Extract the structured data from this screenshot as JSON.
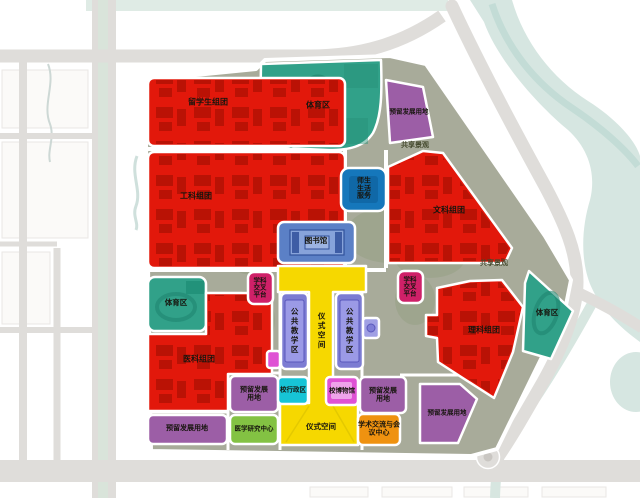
{
  "map": {
    "labels": {
      "intl_students": "留学生组团",
      "engineering": "工科组团",
      "liberal_arts": "文科组团",
      "science": "理科组团",
      "medical": "医科组团",
      "sports": "体育区",
      "library": "图书馆",
      "public_teaching": "公共教学区",
      "ceremony_space": "仪式空间",
      "interdisciplinary": "学科交叉平台",
      "admin": "校行政区",
      "museum": "校博物馆",
      "faculty_student_life": "师生生活服务",
      "medical_research": "医学研究中心",
      "academic_exchange": "学术交流与会议中心",
      "reserved_land": "预留发展用地",
      "shared_landscape": "共享景观"
    },
    "colors": {
      "cluster_red": "#e2180b",
      "sports_teal": "#31a189",
      "reserved_purple": "#9c5ea6",
      "library_blue": "#5b80c6",
      "teaching_periwinkle": "#7c7cd2",
      "ceremony_yellow": "#f6d800",
      "interdisciplinary_rose": "#cf2068",
      "admin_cyan": "#17c4d6",
      "museum_magenta": "#df52d4",
      "research_green": "#83c243",
      "exchange_orange": "#ef9210",
      "life_blue": "#1577bb",
      "site_ground": "#a8ab9a",
      "road_gray": "#dfddda",
      "water": "#d5e6e0"
    }
  }
}
